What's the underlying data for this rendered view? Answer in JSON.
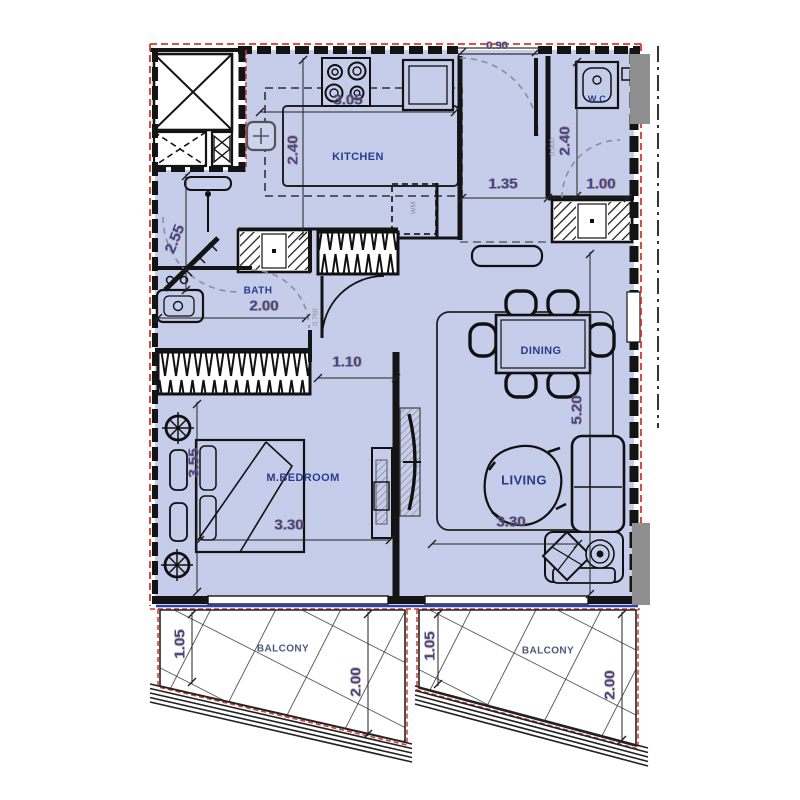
{
  "title": "apartment-unit-floor-plan",
  "rooms": {
    "kitchen": "KITCHEN",
    "wc": "W.C",
    "bath": "BATH",
    "dining": "DINING",
    "living": "LIVING",
    "bedroom": "M.BEDROOM",
    "balcony_left": "BALCONY",
    "balcony_right": "BALCONY",
    "washing_machine": "WM"
  },
  "dims": {
    "entry_door": "0.90",
    "kitchen_width": "3.05",
    "kitchen_depth": "2.40",
    "hall_width": "1.35",
    "wc_depth": "2.40",
    "wc_width": "1.00",
    "wc_door": "0.900",
    "hall_left": "2.55",
    "bath_width": "2.00",
    "corridor_width": "1.10",
    "bath_door": "0.760",
    "dining_depth": "5.20",
    "bedroom_width": "3.30",
    "bedroom_depth": "3.55",
    "living_width": "3.30",
    "balcony_left_depth": "1.05",
    "balcony_left_width": "2.00",
    "balcony_right_depth": "1.05",
    "balcony_right_width": "2.00"
  },
  "colors": {
    "floor": "#c5cdea",
    "wall": "#141414",
    "insulation_red": "#d23a2e",
    "dim_text": "#3b4896",
    "room_text": "#2d3a8c",
    "glazing_blue": "#2e3fb0",
    "shaft_gray": "#8f8f8f"
  }
}
